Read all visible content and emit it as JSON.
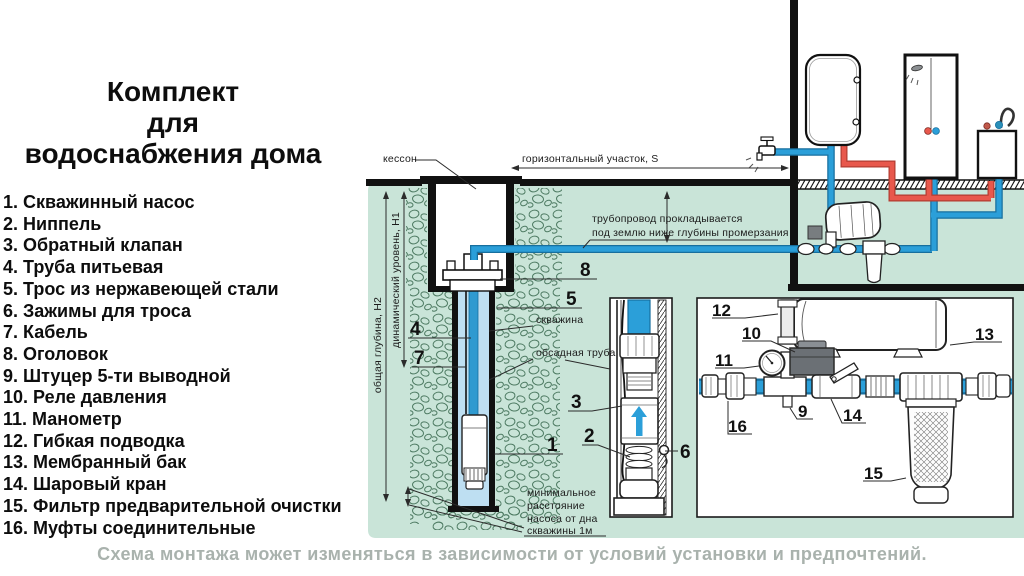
{
  "left_panel": {
    "title_lines": [
      "Комплект",
      "для",
      "водоснабжения дома"
    ],
    "items": [
      "1. Скважинный насос",
      "2. Ниппель",
      "3. Обратный клапан",
      "4. Труба питьевая",
      "5. Трос из нержавеющей стали",
      "6. Зажимы для троса",
      "7. Кабель",
      "8. Оголовок",
      "9. Штуцер 5-ти выводной",
      "10. Реле давления",
      "11. Манометр",
      "12. Гибкая подводка",
      "13. Мембранный бак",
      "14. Шаровый кран",
      "15. Фильтр предварительной очистки",
      "16. Муфты соединительные"
    ]
  },
  "footer": {
    "caption": "Схема монтажа может изменяться в зависимости от условий установки и предпочтений."
  },
  "diagram": {
    "colors": {
      "ground_green": "#c9e4d8",
      "pebble_stroke": "#4d7a62",
      "pipe_blue": "#2b9fd9",
      "pipe_blue_dark": "#176f9e",
      "pipe_red": "#e8584c",
      "pipe_red_dark": "#b23c31",
      "water_blue": "#bedff2",
      "caption_gray": "#a9b2ad"
    },
    "labels": {
      "caisson": "кессон",
      "horizontal_section": "горизонтальный участок, S",
      "pipeline_note_1": "трубопровод прокладывается",
      "pipeline_note_2": "под землю ниже глубины промерзания",
      "total_depth": "общая глубина, Н2",
      "dynamic_level": "динамический уровень, Н1",
      "borehole": "скважина",
      "casing_pipe": "обсадная труба",
      "min_distance_1": "минимальное",
      "min_distance_2": "расстояние",
      "min_distance_3": "насоса от дна",
      "min_distance_4": "скважины 1м"
    },
    "callouts": {
      "n1": "1",
      "n2": "2",
      "n3": "3",
      "n4": "4",
      "n5": "5",
      "n6": "6",
      "n7": "7",
      "n8": "8",
      "n9": "9",
      "n10": "10",
      "n11": "11",
      "n12": "12",
      "n13": "13",
      "n14": "14",
      "n15": "15",
      "n16": "16"
    }
  }
}
